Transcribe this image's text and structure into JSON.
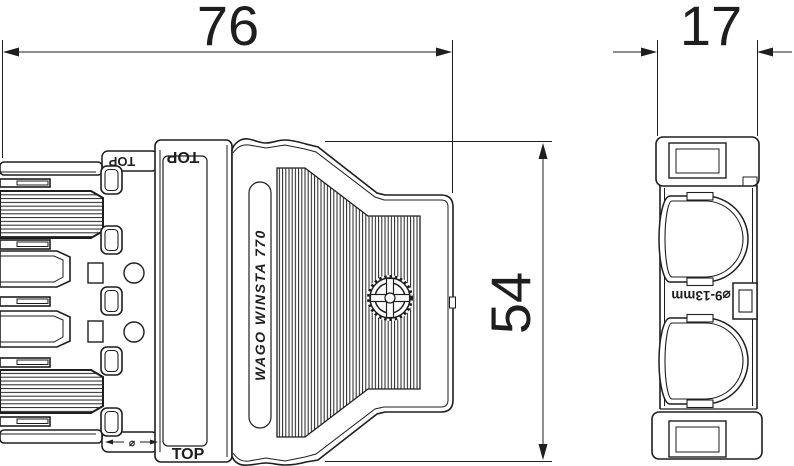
{
  "dimensions": {
    "width": "76",
    "depth": "17",
    "height": "54"
  },
  "labels": {
    "product": "WAGO   WINSTA   770",
    "top_front_upper": "TOP",
    "top_front_lower": "TOP",
    "top_tab": "TOP",
    "cable_range": "⌀9-13mm",
    "diameter_symbol": "⌀"
  },
  "colors": {
    "line": "#1e1e1e",
    "background": "#ffffff"
  }
}
